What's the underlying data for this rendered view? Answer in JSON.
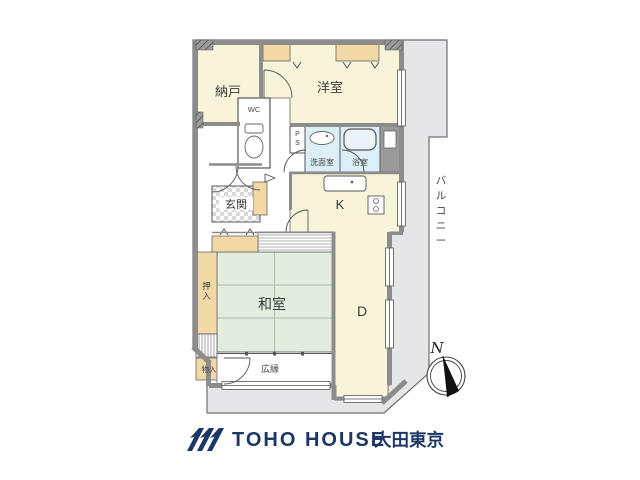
{
  "plan": {
    "rooms": {
      "nando": "納戸",
      "wc": "WC",
      "youshitsu": "洋室",
      "ps": [
        "P",
        "S"
      ],
      "senmenshitsu": "洗面室",
      "yokushitsu": "浴室",
      "genkan": "玄関",
      "kitchen": "K",
      "dining": "D",
      "washitsu": "和室",
      "oshiire": [
        "押",
        "入"
      ],
      "monoiri": "物入",
      "hiroen": "広縁",
      "balcony": [
        "バ",
        "ル",
        "コ",
        "ニ",
        "ー"
      ]
    },
    "compass": {
      "north_label": "N"
    }
  },
  "footer": {
    "brand_name": "TOHO HOUSE",
    "brand_region": "大田東京"
  },
  "colors": {
    "room_cream": "#F8F4DA",
    "tatami_green": "#E2ECDF",
    "closet_tan": "#F1D8A4",
    "wet_blue": "#DCEEF6",
    "wall_gray": "#8C8C8C",
    "balcony_gray": "#E6E6E8",
    "brand_navy": "#1C3666"
  }
}
